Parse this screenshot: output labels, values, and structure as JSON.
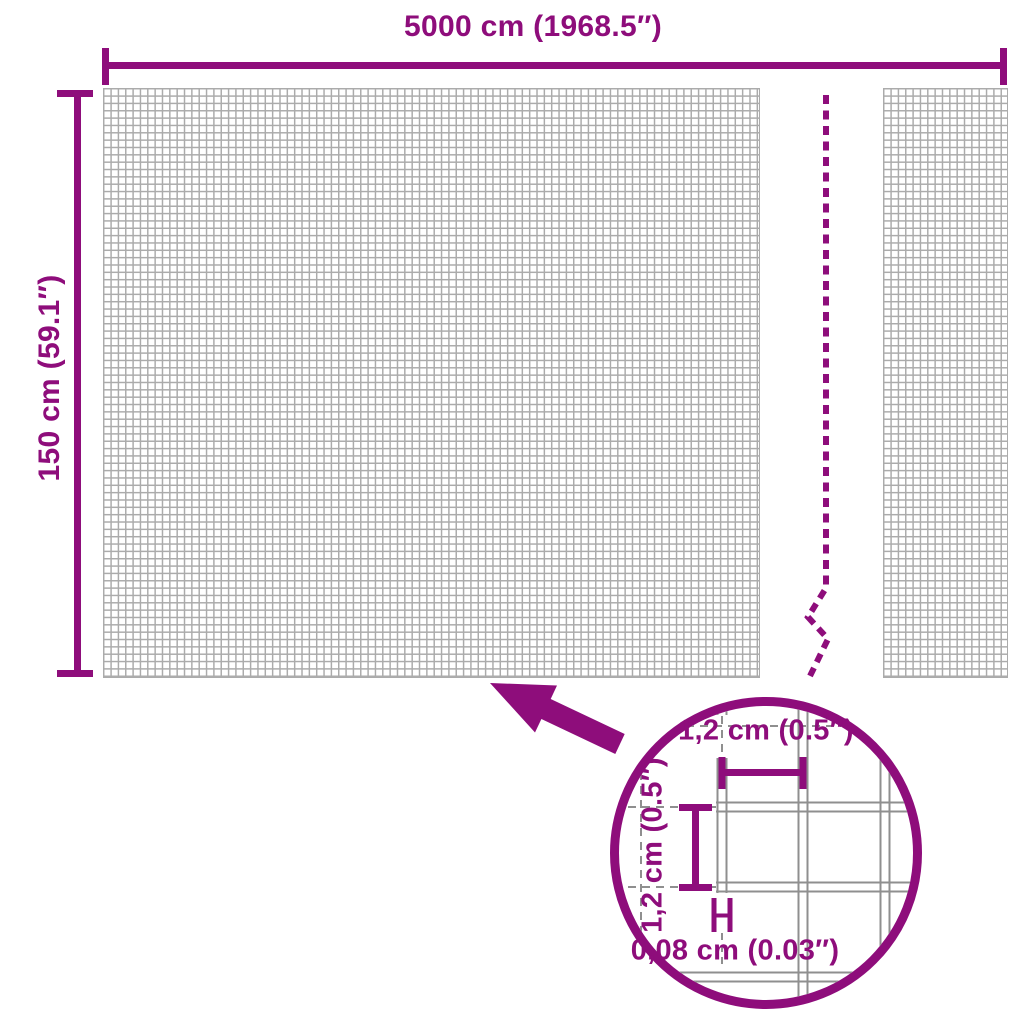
{
  "diagram": {
    "title": "fence-roll-dimension-diagram",
    "width_dimension": {
      "label": "5000 cm (1968.5″)"
    },
    "height_dimension": {
      "label": "150 cm (59.1″)"
    },
    "detail": {
      "mesh_width": {
        "label": "1,2 cm (0.5″)"
      },
      "mesh_height": {
        "label": "1,2 cm (0.5″)"
      },
      "wire_thickness": {
        "label": "0,08 cm (0.03″)"
      }
    },
    "icons": {
      "zoom_arrow": "arrow-pointing-to-mesh",
      "detail_circle": "magnifier-detail-circle",
      "break_line": "dashed-length-break-line"
    }
  },
  "colors": {
    "accent": "#8E0D7B",
    "mesh_grid": "#ababab",
    "detail_wire": "#8f8f8f"
  }
}
